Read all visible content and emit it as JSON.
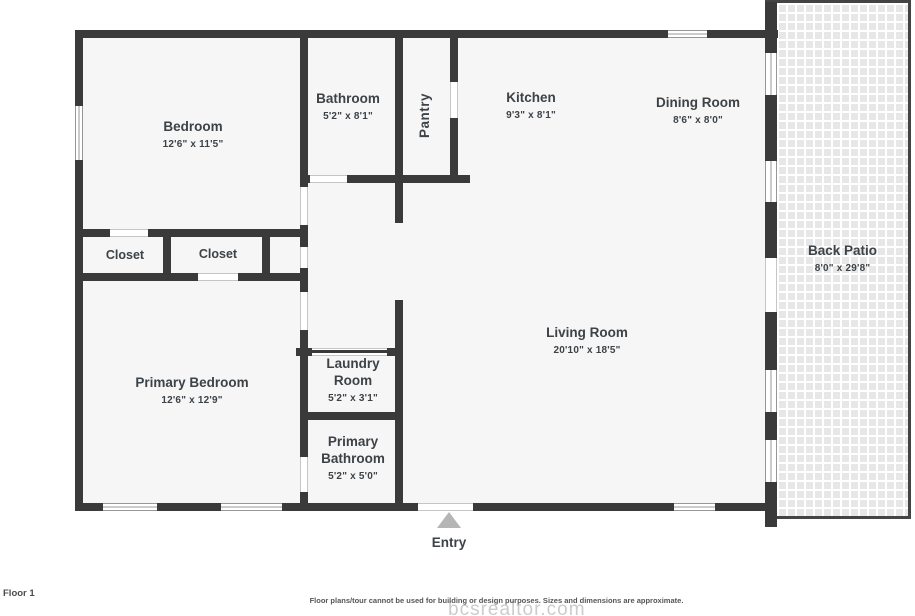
{
  "rooms": {
    "bedroom": {
      "name": "Bedroom",
      "dims": "12'6\" x 11'5\""
    },
    "bathroom": {
      "name": "Bathroom",
      "dims": "5'2\" x 8'1\""
    },
    "pantry": {
      "name": "Pantry"
    },
    "kitchen": {
      "name": "Kitchen",
      "dims": "9'3\" x 8'1\""
    },
    "dining_room": {
      "name": "Dining Room",
      "dims": "8'6\" x 8'0\""
    },
    "closet_1": {
      "name": "Closet"
    },
    "closet_2": {
      "name": "Closet"
    },
    "primary_bedroom": {
      "name": "Primary Bedroom",
      "dims": "12'6\" x 12'9\""
    },
    "laundry_room": {
      "name": "Laundry Room",
      "dims": "5'2\" x 3'1\""
    },
    "primary_bathroom": {
      "name": "Primary Bathroom",
      "dims": "5'2\" x 5'0\""
    },
    "living_room": {
      "name": "Living Room",
      "dims": "20'10\" x 18'5\""
    },
    "back_patio": {
      "name": "Back Patio",
      "dims": "8'0\" x 29'8\""
    }
  },
  "entry": {
    "label": "Entry"
  },
  "floor_label": "Floor 1",
  "disclaimer": "Floor plans/tour cannot be used for building or design purposes. Sizes and dimensions are approximate.",
  "watermark": "bcsrealtor.com",
  "colors": {
    "wall": "#3a3a3a",
    "room_fill": "#f6f6f6",
    "label_text": "#3d4247",
    "entry_arrow": "#b5b5b5",
    "patio_tile": "#e7e7e7"
  }
}
